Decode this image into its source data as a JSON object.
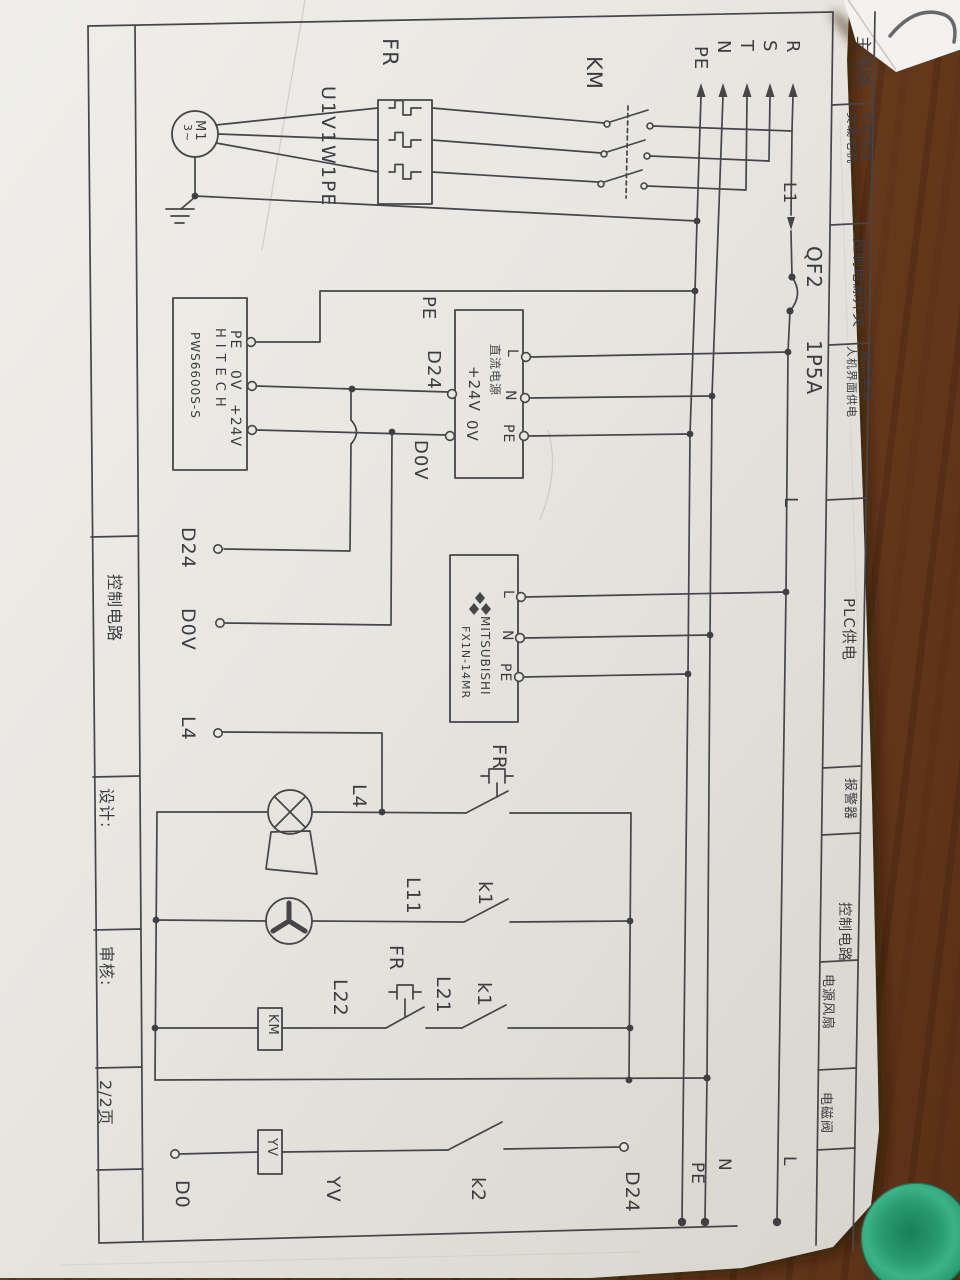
{
  "sheet": {
    "left_strip": {
      "section": "控制电路",
      "design": "设计:",
      "review": "审核:",
      "page": "2/2页"
    },
    "right_strip": {
      "c1": "主电路",
      "c2a": "负载电源",
      "c2b": "负载电机",
      "c3": "控制电源开关",
      "c4a": "直流电源",
      "c4b": "人机界面供电",
      "c5": "PLC供电",
      "c6": "报警器",
      "c7": "控制电路",
      "c8": "电源风扇",
      "c9": "电磁阀"
    }
  },
  "supply": {
    "r": "R",
    "s": "S",
    "t": "T",
    "n": "N",
    "pe": "PE",
    "l1": "L1",
    "qf": "QF2",
    "qf_rating": "1P5A",
    "l": "L"
  },
  "main": {
    "km": "KM",
    "fr": "FR",
    "motor_wires": "U1V1W1PE",
    "motor": "M1",
    "motor_ph": "3~"
  },
  "hmi": {
    "brand": "HITECH",
    "model": "PWS6600S-S",
    "t_pe": "PE",
    "t_0v": "0V",
    "t_24v": "+24V"
  },
  "nets": {
    "pe": "PE",
    "d24": "D24",
    "d0v": "D0V"
  },
  "dc": {
    "stamp": "直流电源",
    "p24": "+24V",
    "v0": "0V",
    "l": "L",
    "n": "N",
    "pe": "PE"
  },
  "plc": {
    "brand": "MITSUBISHI",
    "model": "FX1N-14MR",
    "l": "L",
    "n": "N",
    "pe": "PE"
  },
  "terminals": {
    "d24": "D24",
    "d0v": "D0V",
    "l4": "L4",
    "d0": "D0",
    "d24b": "D24"
  },
  "control": {
    "l4": "L4",
    "fr_top": "FR",
    "l11": "L11",
    "k1a": "k1",
    "fr2": "FR",
    "l22": "L22",
    "l21": "L21",
    "k1b": "k1",
    "km": "KM",
    "yv_box": "YV",
    "yv": "YV",
    "k2": "k2"
  },
  "bottom": {
    "pe": "PE",
    "n": "N",
    "l": "L"
  },
  "colors": {
    "ink": "#45454a",
    "paper": "#e9e7e2",
    "wood": "#7e4c27",
    "sticker": "#2f9e74"
  }
}
